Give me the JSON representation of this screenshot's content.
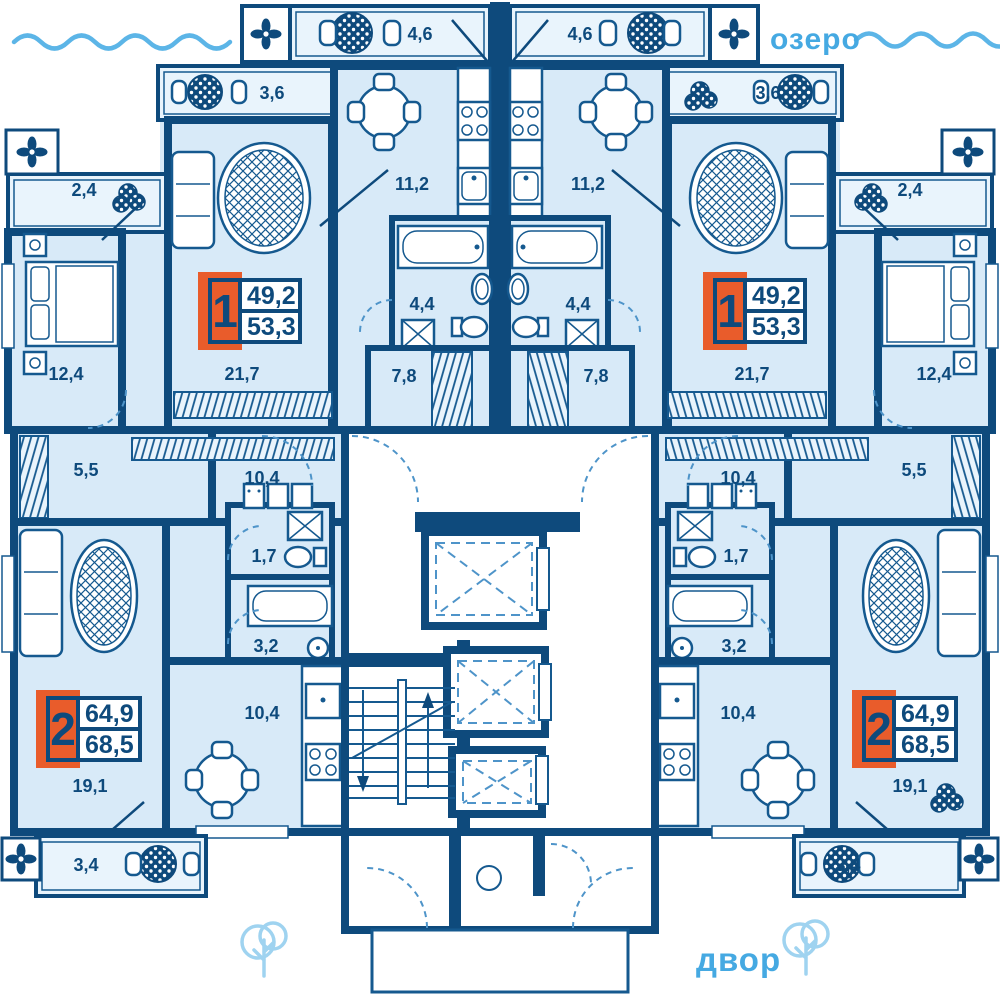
{
  "environment": {
    "lake": "озеро",
    "yard": "двор"
  },
  "apartments": {
    "one": {
      "number": "1",
      "living_area": "49,2",
      "total_area": "53,3"
    },
    "two": {
      "number": "2",
      "living_area": "64,9",
      "total_area": "68,5"
    }
  },
  "rooms": {
    "top_balcony": "4,6",
    "upper_balcony": "3,6",
    "side_balcony": "2,4",
    "kitchen_one": "11,2",
    "bedroom": "12,4",
    "living_one": "21,7",
    "bathroom_one": "4,4",
    "hall_one": "7,8",
    "hall_two": "5,5",
    "corridor_two": "10,4",
    "wc_two": "1,7",
    "bathroom_two": "3,2",
    "living_two": "19,1",
    "kitchen_two": "10,4",
    "bottom_balcony": "3,4"
  },
  "colors": {
    "wall": "#0e4a7c",
    "room_fill": "#d8eaf8",
    "balcony_fill": "#e9f4fc",
    "accent": "#45a9e2",
    "badge_orange": "#e95c2b"
  }
}
